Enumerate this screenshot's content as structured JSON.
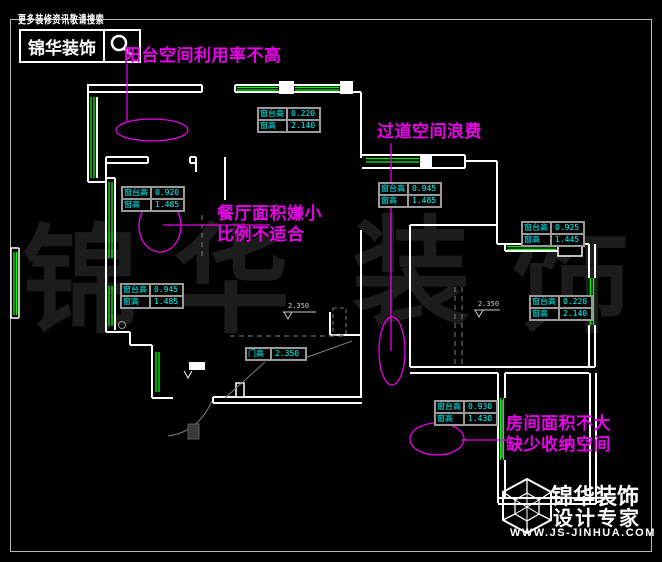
{
  "header": {
    "search_hint": "更多装修资讯敬请搜索",
    "logo_text": "锦华装饰",
    "search_icon": "magnifier-icon"
  },
  "annotations": {
    "balcony": "阳台空间利用率不高",
    "corridor": "过道空间浪费",
    "dining_line1": "餐厅面积嫌小",
    "dining_line2": "比例不适合",
    "room_line1": "房间面积不大",
    "room_line2": "缺少收纳空间"
  },
  "window_tables": [
    {
      "rows": [
        [
          "窗台高",
          "0.220"
        ],
        [
          "窗高",
          "2.140"
        ]
      ]
    },
    {
      "rows": [
        [
          "窗台高",
          "0.920"
        ],
        [
          "窗高",
          "1.485"
        ]
      ]
    },
    {
      "rows": [
        [
          "窗台高",
          "0.945"
        ],
        [
          "窗高",
          "1.485"
        ]
      ]
    },
    {
      "rows": [
        [
          "窗台高",
          "0.945"
        ],
        [
          "窗高",
          "1.485"
        ]
      ]
    },
    {
      "rows": [
        [
          "窗台高",
          "0.925"
        ],
        [
          "窗高",
          "1.445"
        ]
      ]
    },
    {
      "rows": [
        [
          "窗台高",
          "0.220"
        ],
        [
          "窗高",
          "2.140"
        ]
      ]
    },
    {
      "rows": [
        [
          "窗台高",
          "0.930"
        ],
        [
          "窗高",
          "1.430"
        ]
      ]
    }
  ],
  "door_table": {
    "label": "门高",
    "value": "2.350"
  },
  "elevation_marks": [
    {
      "value": "2.350"
    },
    {
      "value": "2.350"
    }
  ],
  "watermark": [
    "锦",
    "华",
    "装",
    "饰"
  ],
  "footer": {
    "brand_line1": "锦华装饰",
    "brand_line2": "设计专家",
    "website": "WWW.JS-JINHUA.COM"
  },
  "colors": {
    "background": "#000000",
    "wall": "#ffffff",
    "window_green": "#00ff00",
    "dimension_cyan": "#00ffff",
    "annotation_magenta": "#ea00ea",
    "detail_gray": "#9a9a9a",
    "watermark_gray": "#1c1c1c"
  }
}
